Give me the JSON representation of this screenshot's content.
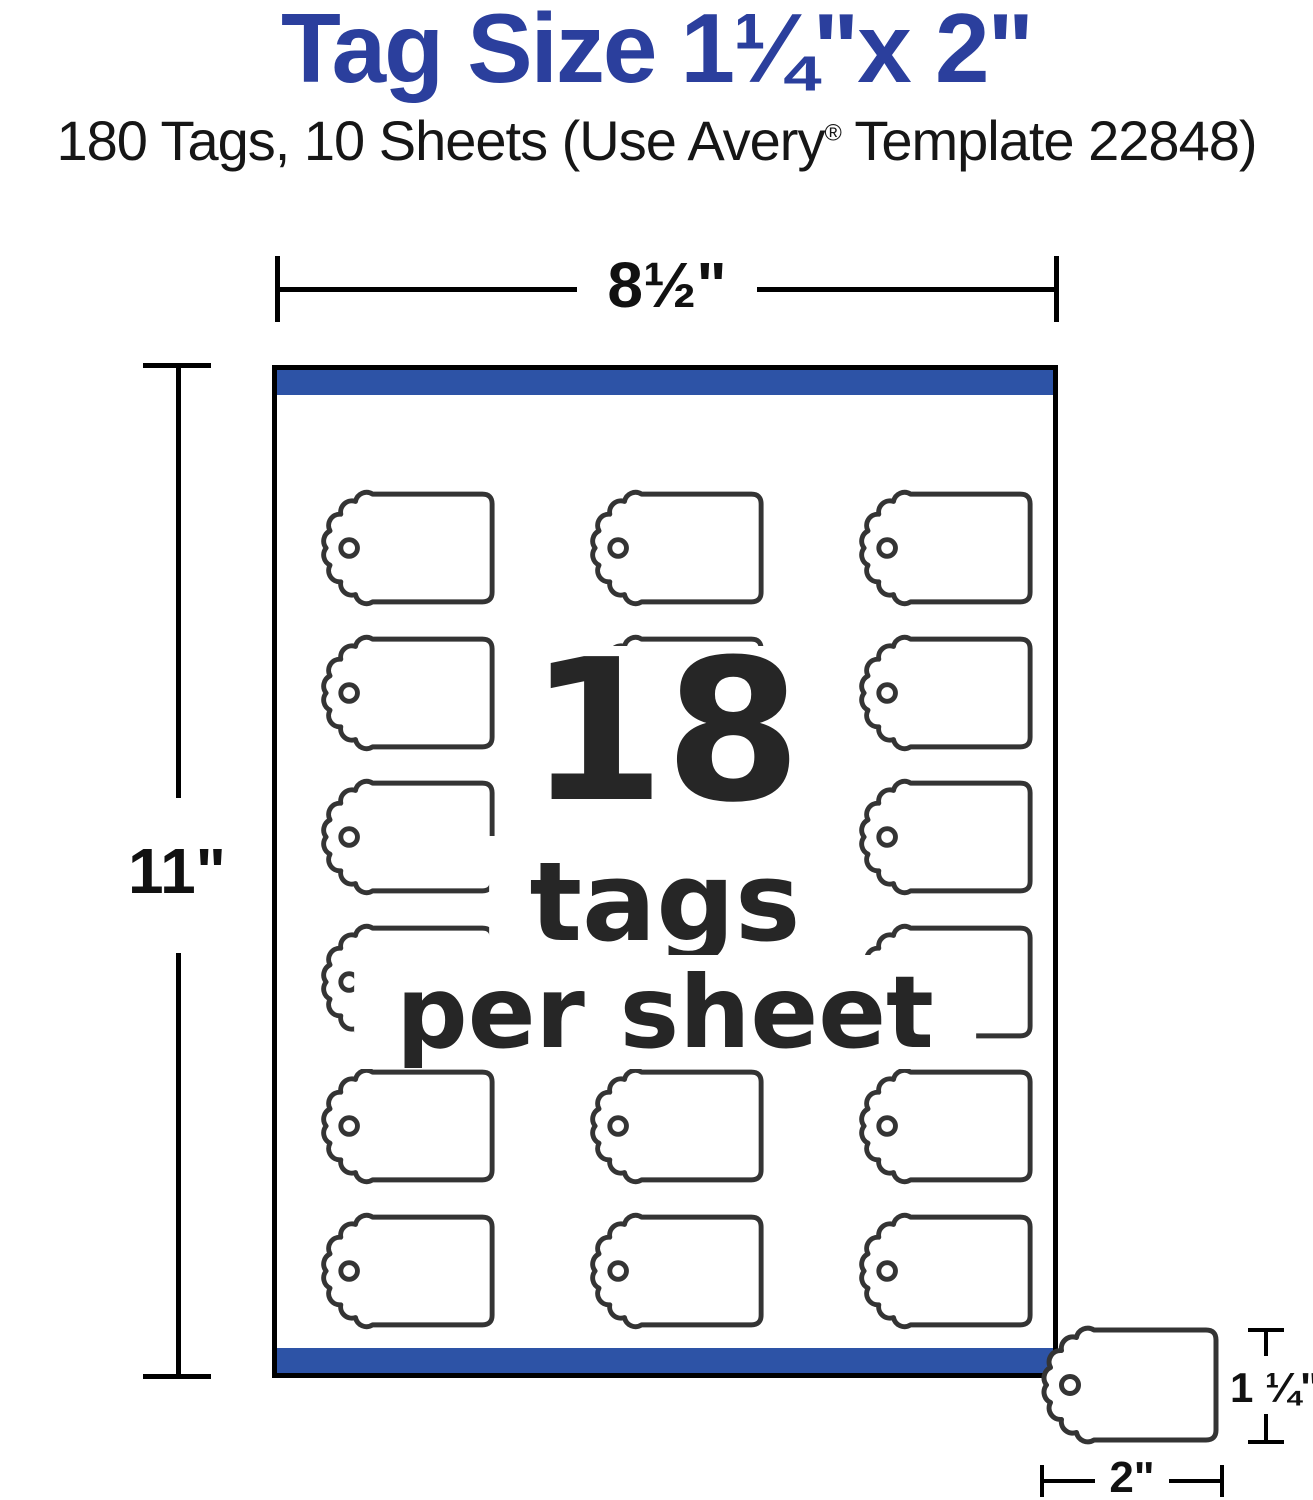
{
  "header": {
    "title": "Tag Size 1¼\"x 2\"",
    "subtitle_before_reg": "180 Tags, 10 Sheets (Use Avery",
    "subtitle_reg": "®",
    "subtitle_after_reg": " Template 22848)"
  },
  "dimensions": {
    "sheet_width_label": "8½\"",
    "sheet_height_label": "11\"",
    "tag_height_label": "1 ¼\"",
    "tag_width_label": "2\""
  },
  "sheet": {
    "center_count": "18",
    "center_line2": "tags",
    "center_line3": "per sheet",
    "rows": 6,
    "cols": 3
  },
  "icons": {
    "tag_shape": "price-tag-outline-with-scalloped-end-and-string-hole"
  },
  "colors": {
    "title_blue": "#2b3f9d",
    "strip_blue": "#2d53a6",
    "tag_outline_gray": "#343434",
    "dimension_black": "#000000"
  }
}
